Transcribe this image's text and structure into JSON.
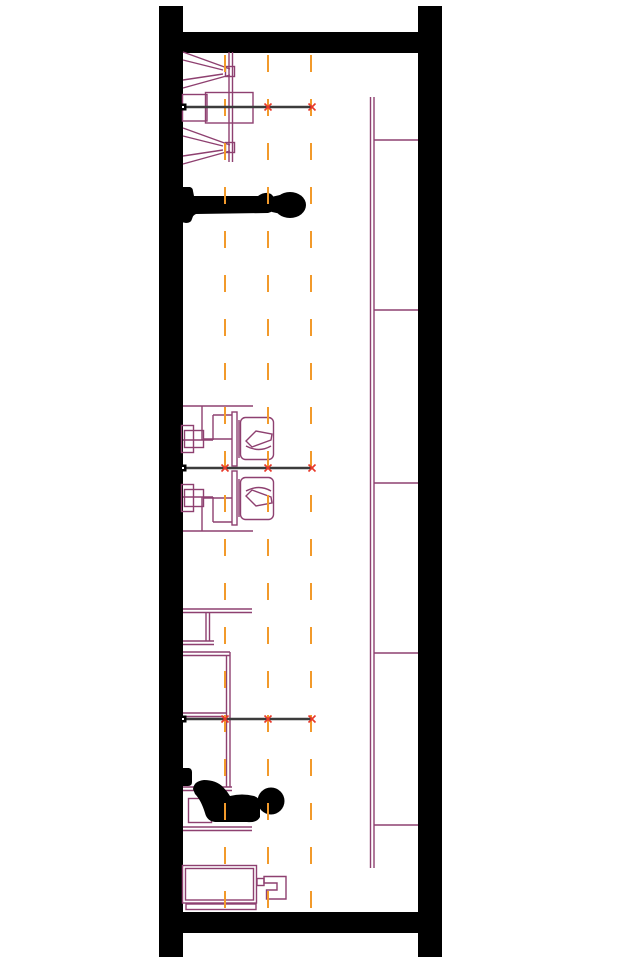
{
  "drawing": {
    "canvas": {
      "width": 624,
      "height": 964,
      "background": "#ffffff"
    },
    "colors": {
      "wall": "#000000",
      "equipment": "#8e4070",
      "grid": "#f29a2b",
      "section_line": "#3c3c3c",
      "tick_marker": "#e8392a",
      "figure": "#000000",
      "background": "#ffffff"
    },
    "structure": {
      "left_column": {
        "x": 159,
        "y": 6,
        "width": 24,
        "height": 951
      },
      "right_column": {
        "x": 418,
        "y": 6,
        "width": 24,
        "height": 951
      },
      "top_beam": {
        "x": 159,
        "y": 32,
        "width": 283,
        "height": 21
      },
      "bottom_beam": {
        "x": 159,
        "y": 912,
        "width": 283,
        "height": 21
      }
    },
    "grid_lines": {
      "xs": [
        225,
        268,
        311
      ],
      "y_start": 55,
      "y_end": 911,
      "dash": [
        17,
        27
      ],
      "stroke_width": 2
    },
    "ladder": {
      "rail_x": 370.5,
      "rail_gap": 3.5,
      "y_start": 97,
      "y_end": 868,
      "rung_end_x": 418,
      "rung_ys": [
        140,
        310,
        483,
        653,
        825
      ]
    },
    "section_lines": [
      {
        "y": 107,
        "x1": 183,
        "x2": 313,
        "cross_xs": [
          268,
          312
        ]
      },
      {
        "y": 468,
        "x1": 183,
        "x2": 313,
        "cross_xs": [
          225,
          268,
          312
        ]
      },
      {
        "y": 719,
        "x1": 183,
        "x2": 313,
        "cross_xs": [
          225,
          268,
          312
        ]
      }
    ],
    "elements_legend": [
      "wall-columns",
      "floor-beams",
      "grid-dashed-lines",
      "ladder",
      "section-cut-lines",
      "trainer-apparatus-top",
      "person-lying",
      "exercise-station-pair",
      "rack-short",
      "rack-long",
      "bench-with-seated-person",
      "cabinet-with-hook"
    ]
  }
}
